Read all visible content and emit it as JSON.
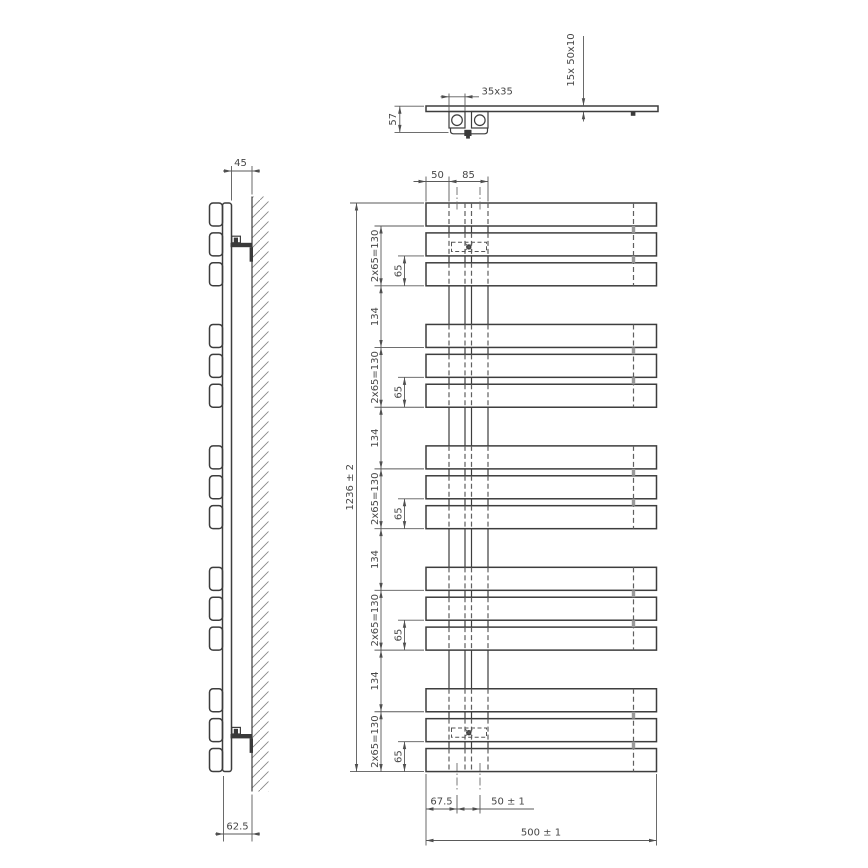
{
  "views": {
    "top": {
      "label": "top-view",
      "dims": {
        "fitting_size": "35x35",
        "total_depth": "57",
        "tube_spec": "15x  50x10"
      }
    },
    "side": {
      "label": "side-view",
      "dims": {
        "wall_clearance": "45",
        "wall_to_face": "62.5"
      }
    },
    "front": {
      "label": "front-view",
      "dims": {
        "edge_to_pipe": "50",
        "pipe_zone": "85",
        "overall_height": "1236 ± 2",
        "tube_group": "2x65=130",
        "group_gap": "134",
        "tube_pitch": "65",
        "edge_to_first_center": "67.5",
        "connection_pitch": "50 ± 1",
        "overall_width": "500 ± 1"
      }
    }
  },
  "structure": {
    "tube_count": 15,
    "tube_groups": 5,
    "tubes_per_group": 3,
    "tube_height_mm": 50,
    "tube_pitch_mm": 65,
    "group_bottom_to_bottom_mm": 134,
    "overall_height_mm": 1236,
    "overall_width_mm": 500,
    "tube_profile": "50x10",
    "connection_size_mm": 35,
    "connection_pitch_mm": 50
  },
  "colors": {
    "background": "#ffffff",
    "object_line": "#3d3d3d",
    "dim_line": "#5a5a5a",
    "text": "#464646",
    "hatch": "#888888",
    "hidden_line": "#5f5f5f"
  }
}
